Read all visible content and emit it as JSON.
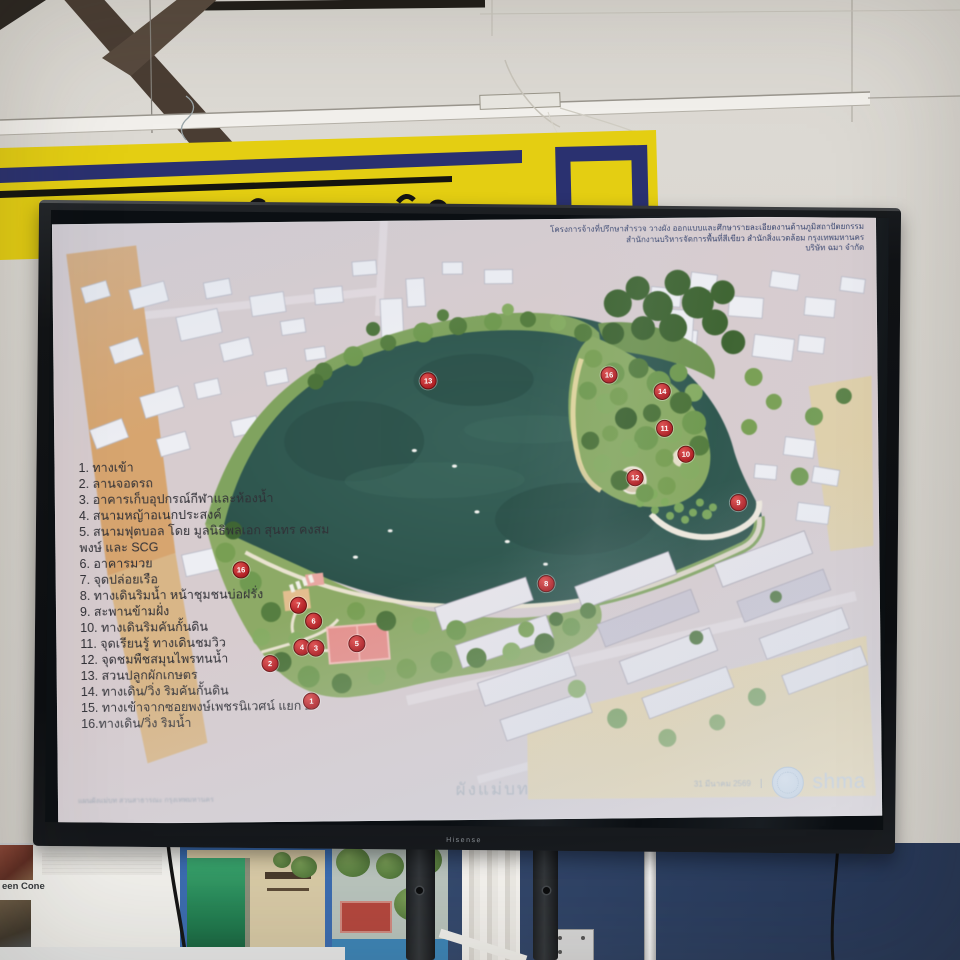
{
  "tv": {
    "brand": "Hisense"
  },
  "slide": {
    "header": {
      "line1": "โครงการจ้างที่ปรึกษาสำรวจ วางผัง ออกแบบและศึกษารายละเอียดงานด้านภูมิสถาปัตยกรรม",
      "line2": "สำนักงานบริหารจัดการพื้นที่สีเขียว สำนักสิ่งแวดล้อม กรุงเทพมหานคร",
      "line3": "บริษัท ฉมา จำกัด"
    },
    "legend": {
      "items": [
        "1.  ทางเข้า",
        "2. ลานจอดรถ",
        "3. อาคารเก็บอุปกรณ์กีฬาและห้องน้ำ",
        "4. สนามหญ้าอเนกประสงค์",
        "5. สนามฟุตบอล โดย มูลนิธิพลเอก สุนทร คงสมพงษ์ และ SCG",
        "6. อาคารมวย",
        "7. จุดปล่อยเรือ",
        "8. ทางเดินริมน้ำ หน้าชุมชนบ่อฝรั่ง",
        "9. สะพานข้ามฝั่ง",
        "10. ทางเดินริมคันกั้นดิน",
        "11. จุดเรียนรู้ ทางเดินชมวิว",
        "12. จุดชมพืชสมุนไพรทนน้ำ",
        "13. สวนปลูกผักเกษตร",
        "14. ทางเดิน/วิ่ง ริมคันกั้นดิน",
        "15. ทางเข้าจากซอยพงษ์เพชรนิเวศน์ แยก 2",
        "16.ทางเดิน/วิ่ง ริมน้ำ"
      ]
    },
    "caption": "ผังแม่บท",
    "footer": {
      "left_caption": "แผนผังแม่บท สวนสาธารณะ กรุงเทพมหานคร",
      "date": "31 มีนาคม 2569",
      "divider": "|",
      "firm": "shma"
    }
  },
  "map_data": {
    "type": "site-plan",
    "title": "ผังแม่บท",
    "markers": [
      {
        "n": "13",
        "x": 374,
        "y": 160
      },
      {
        "n": "16",
        "x": 555,
        "y": 156
      },
      {
        "n": "14",
        "x": 608,
        "y": 173
      },
      {
        "n": "11",
        "x": 610,
        "y": 210
      },
      {
        "n": "10",
        "x": 631,
        "y": 236
      },
      {
        "n": "12",
        "x": 580,
        "y": 259
      },
      {
        "n": "9",
        "x": 683,
        "y": 285
      },
      {
        "n": "8",
        "x": 490,
        "y": 364
      },
      {
        "n": "16",
        "x": 185,
        "y": 347
      },
      {
        "n": "7",
        "x": 242,
        "y": 383
      },
      {
        "n": "6",
        "x": 257,
        "y": 399
      },
      {
        "n": "4",
        "x": 245,
        "y": 425
      },
      {
        "n": "3",
        "x": 259,
        "y": 426
      },
      {
        "n": "5",
        "x": 300,
        "y": 422
      },
      {
        "n": "2",
        "x": 213,
        "y": 441
      },
      {
        "n": "1",
        "x": 254,
        "y": 479
      }
    ],
    "colors": {
      "lake": "#2e5a52",
      "park": "#86a95e",
      "marker": "#b02025",
      "urban": "#d7cccf"
    }
  },
  "posters": {
    "left_text": "een Cone"
  }
}
